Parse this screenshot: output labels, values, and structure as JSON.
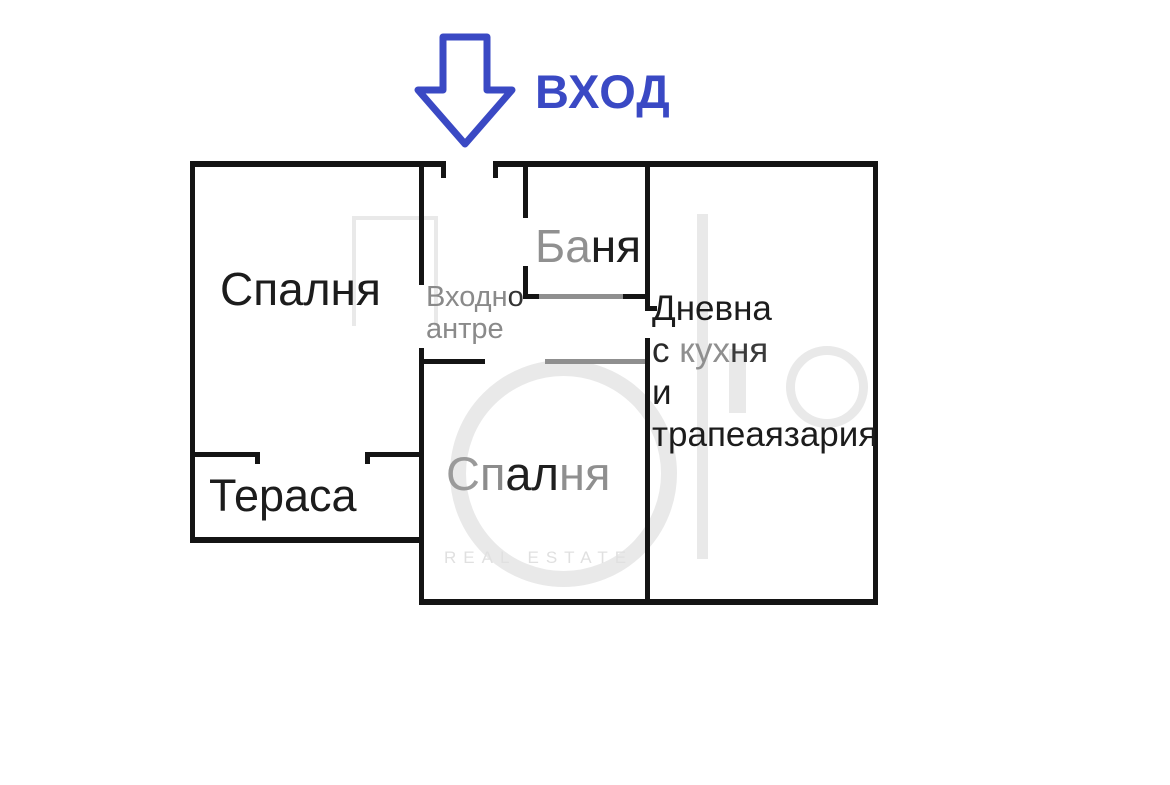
{
  "entrance": {
    "label": "ВХОД"
  },
  "rooms": {
    "bedroom_left": {
      "label": "Спалня"
    },
    "terrace": {
      "label": "Тераса"
    },
    "entry_hall": {
      "lines": [
        "Входно",
        "антре"
      ],
      "line1_segments": [
        {
          "text": "Входн",
          "color": "#8a8a8a"
        },
        {
          "text": "о",
          "color": "#333333"
        }
      ]
    },
    "bathroom": {
      "label": "Баня",
      "segments": [
        {
          "text": "Ба",
          "color": "#909090"
        },
        {
          "text": "ня",
          "color": "#1e1e1e"
        }
      ]
    },
    "bedroom_middle": {
      "label": "Спалня",
      "segments": [
        {
          "text": "С",
          "color": "#9a9a9a"
        },
        {
          "text": "п",
          "color": "#8c8c8c"
        },
        {
          "text": "ал",
          "color": "#1f1f1f"
        },
        {
          "text": "ня",
          "color": "#8f8f8f"
        }
      ]
    },
    "living": {
      "lines": [
        "Дневна",
        "с кухня",
        "и",
        "трапеаязария"
      ],
      "line2_segments": [
        {
          "text": "с ",
          "color": "#2a2a2a"
        },
        {
          "text": "кух",
          "color": "#8f8f8f"
        },
        {
          "text": "ня",
          "color": "#3a3a3a"
        }
      ]
    }
  },
  "watermark": {
    "text": "REAL ESTATE"
  },
  "colors": {
    "wall": "#141414",
    "wall_light": "#8f8f8f",
    "accent_blue": "#3a49c4",
    "label_dark": "#1c1c1c",
    "label_gray": "#8a8a8a",
    "watermark": "#e9e9e9"
  }
}
